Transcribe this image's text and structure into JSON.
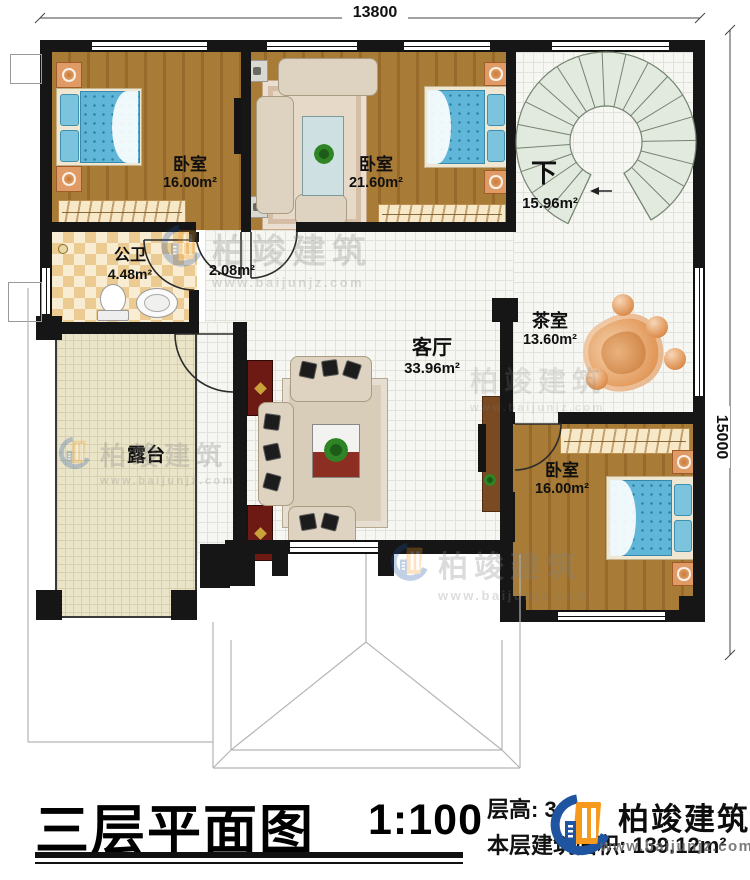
{
  "dimensions": {
    "top_width": "13800",
    "right_height": "15000"
  },
  "rooms": {
    "bedroom_top_left": {
      "name": "卧室",
      "area": "16.00m²"
    },
    "bedroom_top_middle": {
      "name": "卧室",
      "area": "21.60m²"
    },
    "stairwell": {
      "direction_label": "下",
      "area": "15.96m²"
    },
    "bathroom": {
      "name": "公卫",
      "area": "4.48m²"
    },
    "corridor": {
      "area": "2.08m²"
    },
    "living_room": {
      "name": "客厅",
      "area": "33.96m²"
    },
    "tea_room": {
      "name": "茶室",
      "area": "13.60m²"
    },
    "bedroom_bottom_right": {
      "name": "卧室",
      "area": "16.00m²"
    },
    "terrace": {
      "name": "露台"
    }
  },
  "title_block": {
    "title": "三层平面图",
    "scale": "1:100",
    "floor_height": "层高: 3.",
    "floor_area": "本层建筑面积: 139.12m²",
    "brand": "柏竣建筑",
    "website": "www.baijunjz.com"
  },
  "watermark": {
    "brand": "柏竣建筑",
    "website": "www.baijunjz.com"
  },
  "colors": {
    "wall": "#161616",
    "wood": "#a87b36",
    "wood_dark": "#97692a",
    "tile": "#f6f6f2",
    "terrace": "#eae5c9",
    "mattress": "#5fb6d8",
    "cabinet_red": "#6e1a14",
    "tvcab_brown": "#7a4a22",
    "wardrobe": "#f7e9c8",
    "nightstand": "#e09a66",
    "tea_orange": "#e29a5c",
    "logo_blue": "#1f55a0",
    "logo_orange": "#f59a1d"
  }
}
